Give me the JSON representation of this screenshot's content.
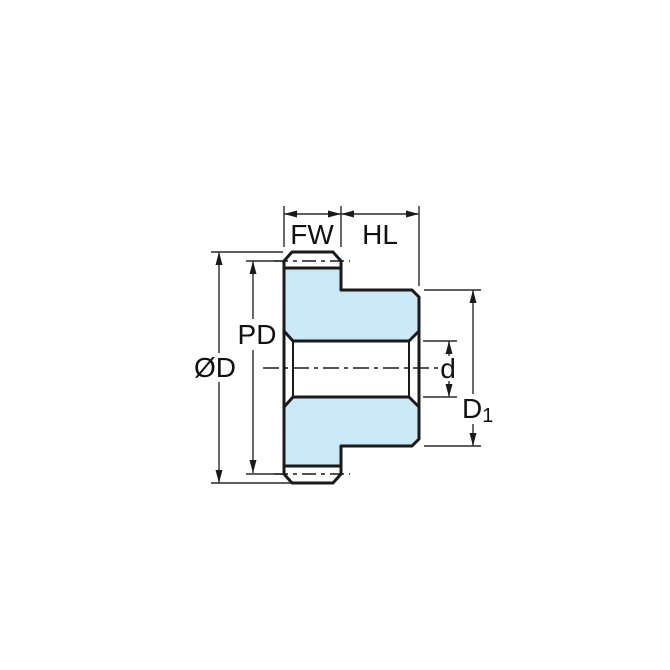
{
  "diagram": {
    "type": "technical-dimension-drawing",
    "subject": "spur gear with hub, cross-section side view",
    "labels": {
      "fw": "FW",
      "hl": "HL",
      "pd": "PD",
      "od": "ØD",
      "d": "d",
      "d1_main": "D",
      "d1_sub": "1"
    },
    "label_meanings": {
      "fw": "face width",
      "hl": "hub length",
      "pd": "pitch diameter",
      "od": "outer diameter",
      "d": "bore diameter",
      "d1": "hub diameter"
    },
    "colors": {
      "body_fill": "#cbe8f7",
      "outline": "#1a1a1a",
      "thin_line": "#2a2a2a",
      "background": "#ffffff"
    }
  }
}
